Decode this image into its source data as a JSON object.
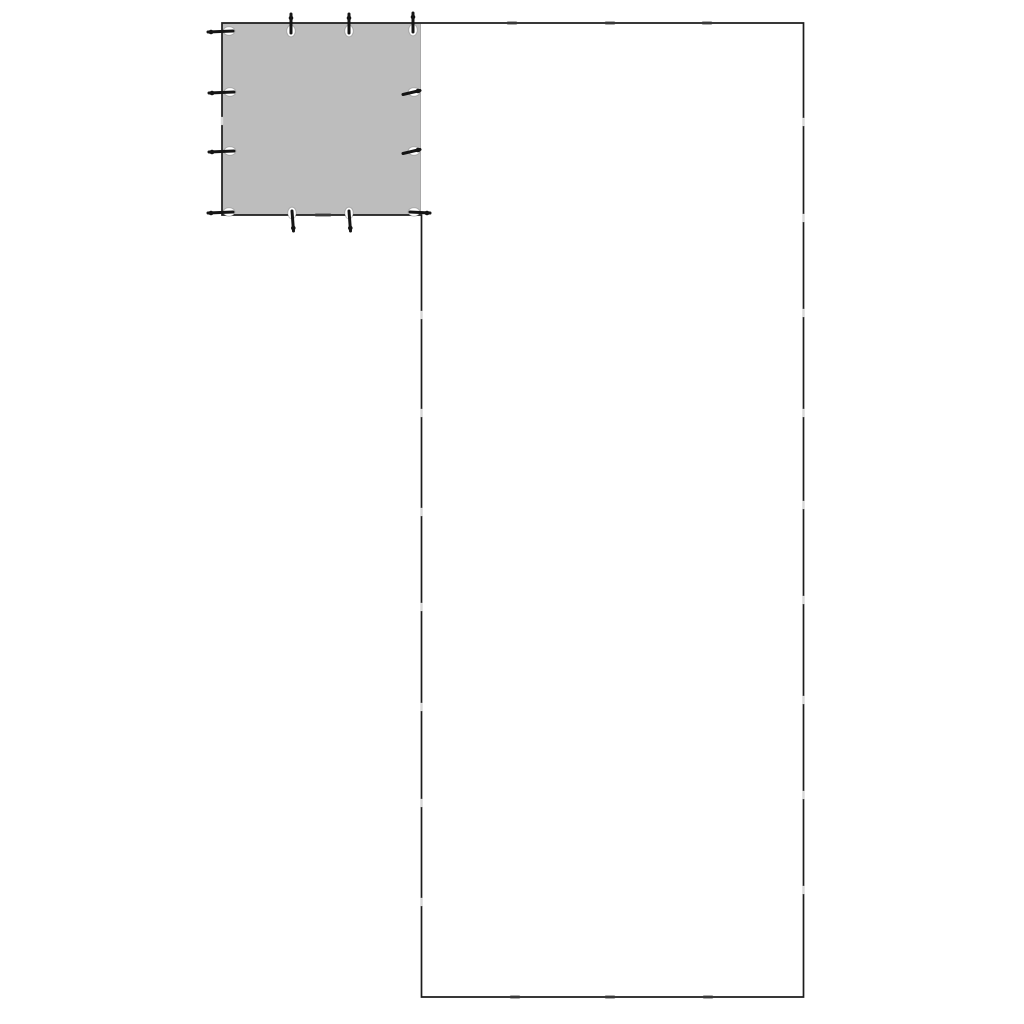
{
  "page": {
    "background": "#ffffff",
    "description": "Line drawing of an L-shaped enclosure footprint with a gray grommeted tarp cover over the top-left square section"
  },
  "diagram": {
    "canvas": {
      "width": 1024,
      "height": 1024
    },
    "colors": {
      "background": "#ffffff",
      "outline": "#1c1c1c",
      "tarp_fill": "#bdbdbd",
      "tarp_right_edge": "#a8a8a8",
      "grommet_fill": "#ffffff",
      "grommet_ring": "rgba(90,90,90,0.35)",
      "peg": "#141414",
      "joint_light": "#d8d8d8",
      "joint_dark": "#3a3a3a"
    },
    "outline_polygon": [
      [
        222,
        23
      ],
      [
        803.5,
        23
      ],
      [
        803.5,
        997
      ],
      [
        421.5,
        997
      ],
      [
        421.5,
        215
      ],
      [
        222,
        215
      ]
    ],
    "outline_stroke_width": 1.7,
    "tarp": {
      "x": 222.5,
      "y": 23.5,
      "width": 198,
      "height": 191.5
    },
    "tarp_right_edge_line": {
      "x": 420.5,
      "y1": 24,
      "y2": 214
    },
    "grommets": [
      {
        "cx": 229,
        "cy": 31,
        "shape": "h",
        "peg": "left",
        "name": "grommet-top-left-corner"
      },
      {
        "cx": 291,
        "cy": 31,
        "shape": "v",
        "peg": "up",
        "name": "grommet-top-2"
      },
      {
        "cx": 349,
        "cy": 31,
        "shape": "v",
        "peg": "up",
        "name": "grommet-top-3"
      },
      {
        "cx": 413,
        "cy": 30,
        "shape": "v",
        "peg": "up",
        "name": "grommet-top-right-corner"
      },
      {
        "cx": 230,
        "cy": 92,
        "shape": "h",
        "peg": "left",
        "name": "grommet-left-2"
      },
      {
        "cx": 230,
        "cy": 151,
        "shape": "h",
        "peg": "left",
        "name": "grommet-left-3"
      },
      {
        "cx": 229,
        "cy": 212,
        "shape": "h",
        "peg": "left",
        "name": "grommet-bottom-left-corner"
      },
      {
        "cx": 414,
        "cy": 92,
        "shape": "h",
        "peg": "hookLeft",
        "name": "grommet-right-2"
      },
      {
        "cx": 414,
        "cy": 151,
        "shape": "h",
        "peg": "hookLeft",
        "name": "grommet-right-3"
      },
      {
        "cx": 414,
        "cy": 212,
        "shape": "h",
        "peg": "right",
        "name": "grommet-bottom-right-corner"
      },
      {
        "cx": 292,
        "cy": 213,
        "shape": "v",
        "peg": "down",
        "name": "grommet-bottom-2"
      },
      {
        "cx": 349,
        "cy": 213,
        "shape": "v",
        "peg": "down",
        "name": "grommet-bottom-3"
      }
    ],
    "grommet_radii": {
      "v": {
        "rx": 4.2,
        "ry": 5.8
      },
      "h": {
        "rx": 5.8,
        "ry": 4.2
      }
    },
    "joints": {
      "top_edge": {
        "y": 23,
        "xs": [
          512,
          610,
          707
        ],
        "style": "dark"
      },
      "bottom_edge": {
        "y": 997,
        "xs": [
          515,
          610,
          708
        ],
        "style": "dark"
      },
      "right_edge": {
        "x": 803.5,
        "ys": [
          122,
          218,
          313,
          413,
          505,
          600,
          700,
          795,
          890
        ],
        "style": "light"
      },
      "left_edge": {
        "x": 421.5,
        "ys": [
          315,
          413,
          512,
          607,
          707,
          803,
          902
        ],
        "style": "light"
      },
      "tarp_left_edge": {
        "x": 222,
        "ys": [
          121
        ],
        "style": "light"
      },
      "tarp_bottom_edge": {
        "y": 215,
        "xs": [
          323
        ],
        "style": "dark"
      }
    }
  }
}
